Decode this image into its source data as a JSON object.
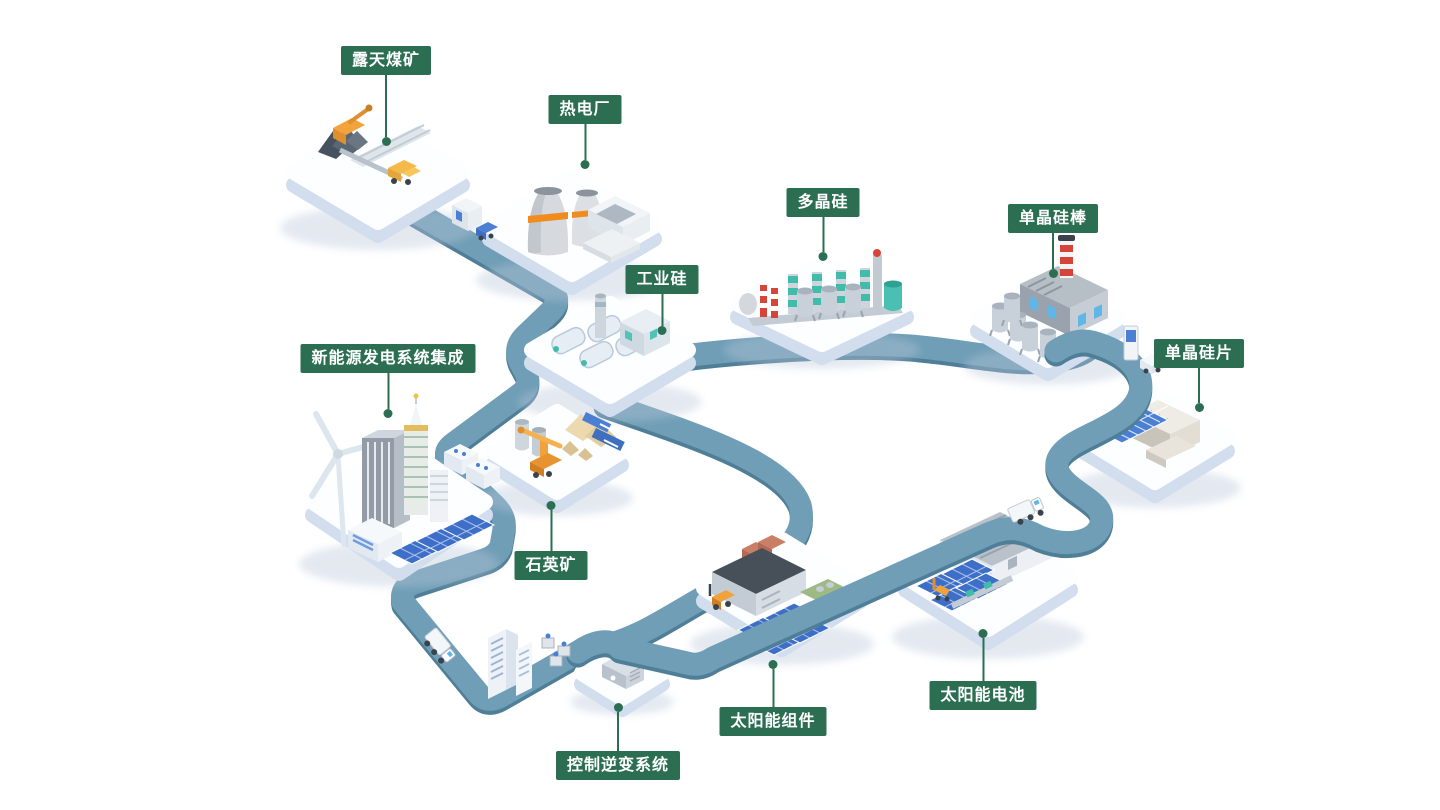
{
  "diagram": {
    "type": "isometric-industry-chain-map",
    "nodes": {
      "coal_mine": {
        "label": "露天煤矿",
        "label_position": "above"
      },
      "thermal_plant": {
        "label": "热电厂",
        "label_position": "above"
      },
      "industrial_silicon": {
        "label": "工业硅",
        "label_position": "above"
      },
      "polysilicon": {
        "label": "多晶硅",
        "label_position": "above"
      },
      "mono_rod": {
        "label": "单晶硅棒",
        "label_position": "above"
      },
      "mono_wafer": {
        "label": "单晶硅片",
        "label_position": "above"
      },
      "system_integration": {
        "label": "新能源发电系统集成",
        "label_position": "above"
      },
      "quartz_mine": {
        "label": "石英矿",
        "label_position": "below"
      },
      "inverter_system": {
        "label": "控制逆变系统",
        "label_position": "below"
      },
      "solar_module": {
        "label": "太阳能组件",
        "label_position": "below"
      },
      "solar_cell": {
        "label": "太阳能电池",
        "label_position": "below"
      }
    },
    "colors": {
      "background": "#ffffff",
      "label_background": "#2b6e52",
      "label_text": "#ffffff",
      "callout_line": "#2b6e52",
      "road": "#6f9eb6",
      "road_edge": "#4f7e98",
      "platform_top": "#fdfeff",
      "platform_side": "#d2deee",
      "accent_teal": "#3fbcaa",
      "accent_orange": "#f0a33c",
      "accent_red": "#d6453a",
      "panel_blue": "#3e6fc8"
    }
  }
}
